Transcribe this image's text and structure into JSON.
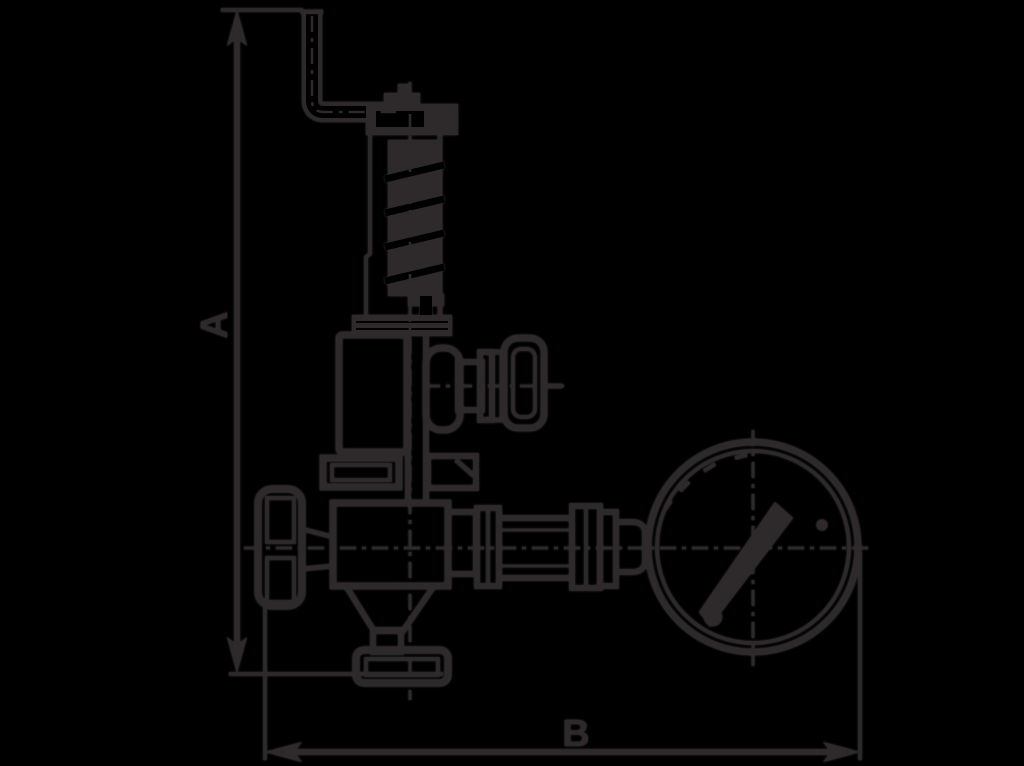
{
  "canvas": {
    "width": 1024,
    "height": 766,
    "background": "#000000",
    "ink": "#2e2a2b"
  },
  "drawing": {
    "type": "technical dimensional line drawing (side elevation)",
    "subject": "spring-loaded safety relief valve with test lever, two shut-off handwheels and a pressure gauge",
    "labels": {
      "dim_vertical": "A",
      "dim_horizontal": "B"
    },
    "dimensions": [
      {
        "id": "A",
        "orientation": "vertical",
        "measures": "overall height from inlet flange bottom to lever top"
      },
      {
        "id": "B",
        "orientation": "horizontal",
        "measures": "overall width from inlet handwheel to gauge rim"
      }
    ],
    "parts": [
      "test-lever-arm",
      "bonnet-cap-nut",
      "spring-bonnet",
      "spring-coil",
      "bonnet-flange",
      "spring-chamber",
      "outlet-handwheel",
      "mid-flange",
      "inlet-handwheel",
      "valve-body",
      "outlet-cone",
      "inlet-flange",
      "outlet-union",
      "gauge-pipe",
      "pressure-gauge",
      "gauge-needle",
      "gauge-screw",
      "needle-hub"
    ]
  }
}
